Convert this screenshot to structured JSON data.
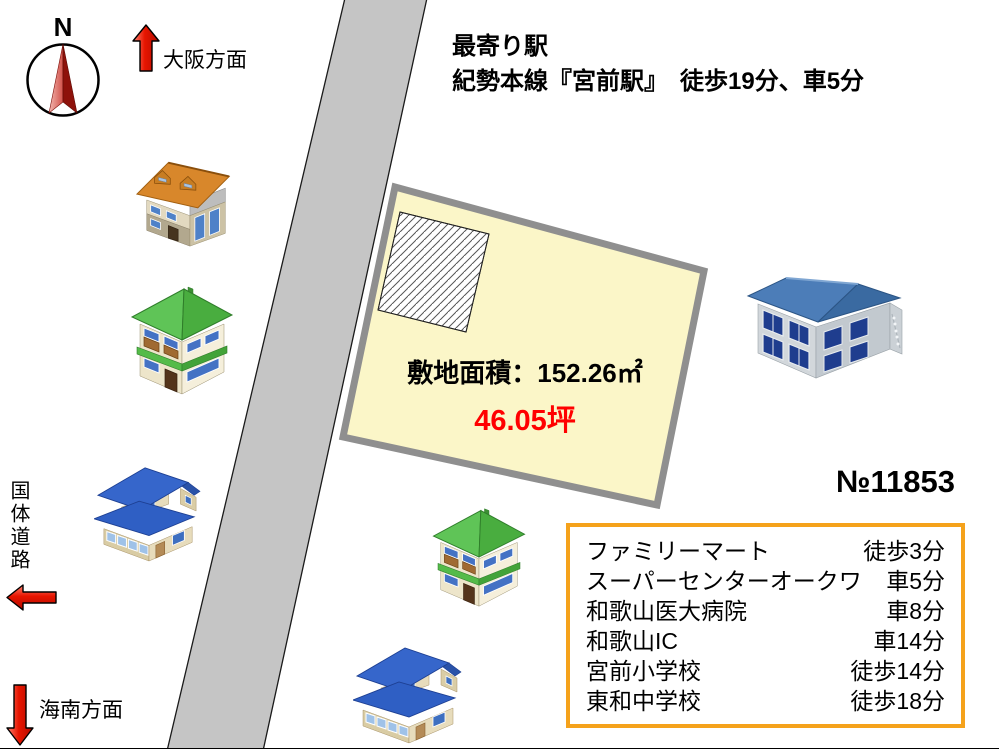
{
  "title_block": {
    "line1": "最寄り駅",
    "line2": "紀勢本線『宮前駅』　徒歩19分、車5分"
  },
  "compass": {
    "north_label": "N"
  },
  "directions": {
    "osaka": "大阪方面",
    "kainan": "海南方面"
  },
  "road": {
    "name": "国体道路",
    "color": "#C5C5C5"
  },
  "plot": {
    "area_text": "敷地面積：152.26㎡",
    "tsubo_text": "46.05坪",
    "fill_color": "#FBF6C8",
    "border_color": "#8F8F8F",
    "tsubo_color": "#FF0000"
  },
  "listing": {
    "number": "№11853"
  },
  "facilities": {
    "border_color": "#F5A21B",
    "items": [
      {
        "name": "ファミリーマート",
        "time": "徒歩3分"
      },
      {
        "name": "スーパーセンターオークワ",
        "time": "車5分"
      },
      {
        "name": "和歌山医大病院",
        "time": "車8分"
      },
      {
        "name": "和歌山IC",
        "time": "車14分"
      },
      {
        "name": "宮前小学校",
        "time": "徒歩14分"
      },
      {
        "name": "東和中学校",
        "time": "徒歩18分"
      }
    ]
  },
  "colors": {
    "accent_red": "#FF0000",
    "arrow_red": "#D81000",
    "orange_roof": "#D8872B",
    "green_roof": "#55BE4A",
    "blue_roof": "#3465CB",
    "apartment_roof": "#4C7DB8"
  }
}
